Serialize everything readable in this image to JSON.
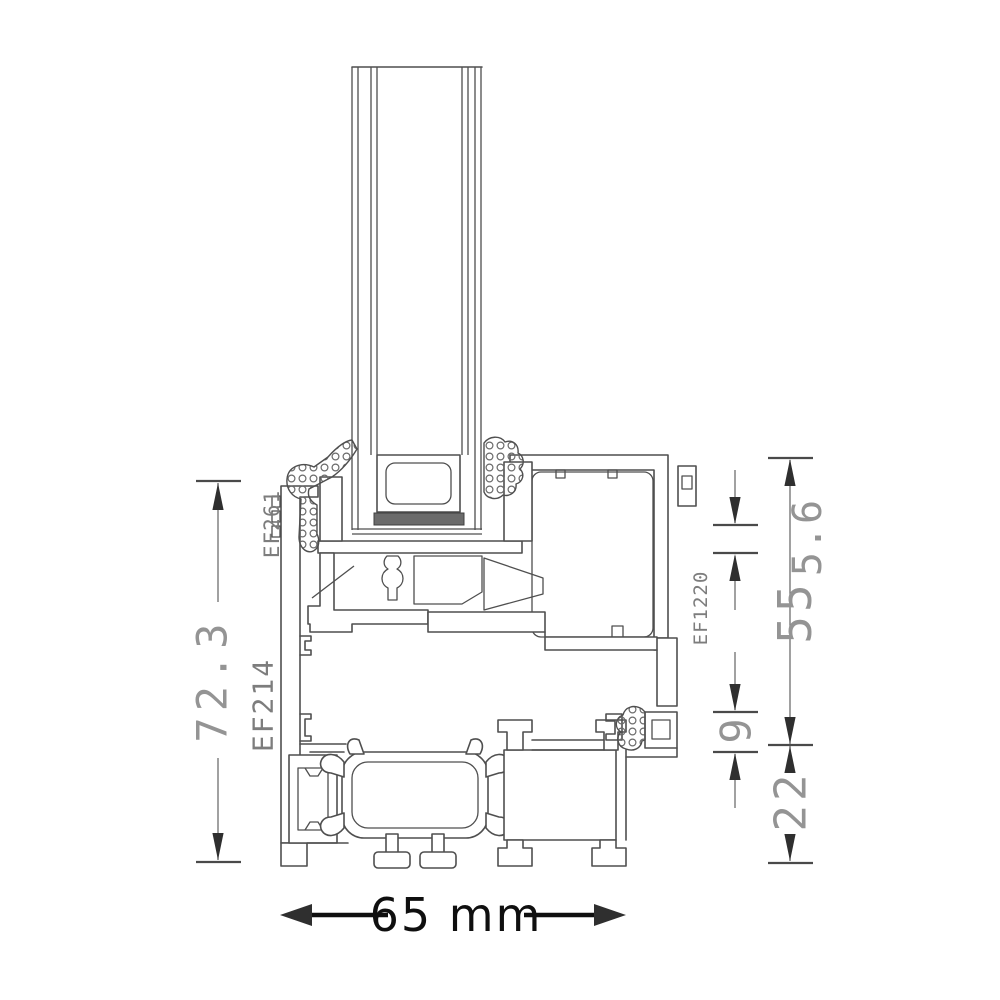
{
  "annotations": {
    "dim_overall_height": "72.3",
    "dim_sash_height": "55",
    "dim_top_offset": "5.6",
    "dim_rebate_gap": "9",
    "dim_base_height": "22",
    "dim_overall_width": "65 mm",
    "label_outer_gasket": "EF261",
    "label_frame_profile": "EF214",
    "label_sash_profile": "EF1220"
  },
  "colors": {
    "background": "#ffffff",
    "profile_line": "#4f4f4f",
    "dimension_line": "#6e6e6e",
    "dimension_text": "#949494",
    "label_text": "#7d7d7d",
    "overall_width_text": "#0f0f0f",
    "seal_fill": "#6b6b6b"
  }
}
